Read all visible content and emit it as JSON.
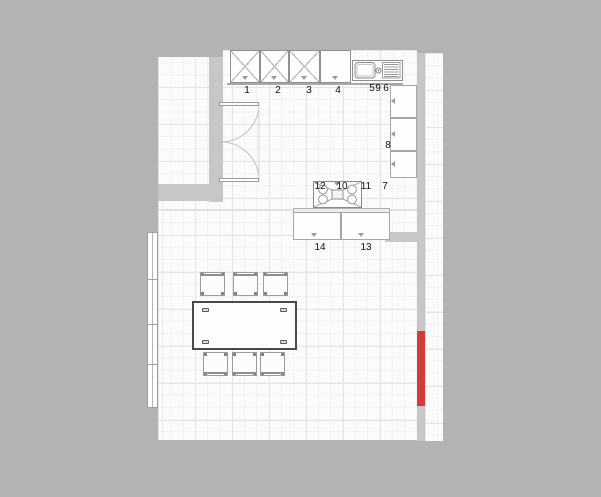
{
  "plan": {
    "labels": {
      "top_cabinets": [
        "1",
        "2",
        "3",
        "4"
      ],
      "sink_unit": [
        "5",
        "9"
      ],
      "right_cabinets": [
        "6",
        "8",
        "7"
      ],
      "hob_row": [
        "12",
        "10",
        "11"
      ],
      "island_base": [
        "14",
        "13"
      ]
    },
    "colors": {
      "background": "#b3b3b3",
      "wall": "#c7c7c7",
      "floor": "#fcfbfb",
      "radiator_red": "#cf3d3d",
      "table_outline": "#4a4a4a"
    }
  }
}
